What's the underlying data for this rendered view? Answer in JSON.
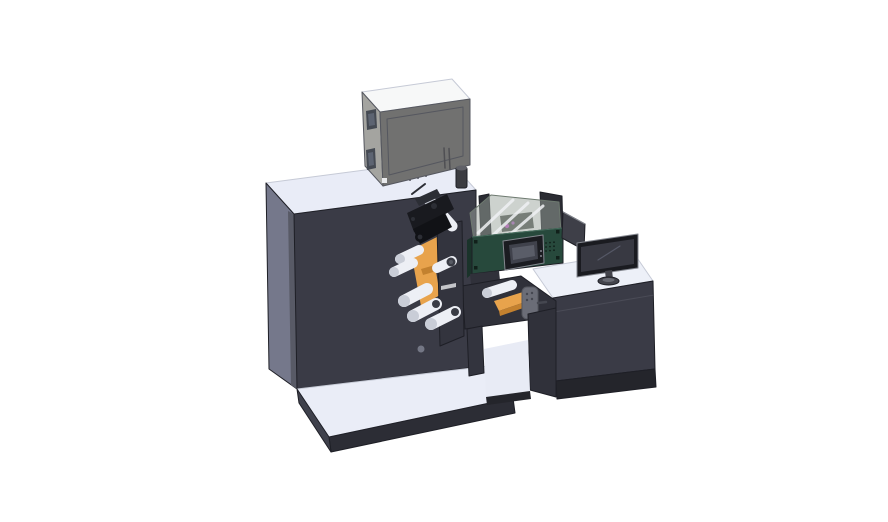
{
  "canvas": {
    "width": 888,
    "height": 522,
    "background": "#ffffff"
  },
  "scene": {
    "kind": "3d-cad-render",
    "parts": [
      "printing-machine-cabinet",
      "electrical-box",
      "exhaust-cylinder",
      "print-head-assembly",
      "guide-rollers",
      "label-web-rolls",
      "winder-door-plate",
      "inspection-unit",
      "protective-hood",
      "hmi-display",
      "operator-desk",
      "desk-side-panel",
      "monitor",
      "base-platform",
      "support-frame"
    ]
  },
  "colors": {
    "bg": "#ffffff",
    "topLight": "#e9ecf7",
    "baseTop": "#eaedf7",
    "cabinetFront": "#3a3b46",
    "cabinetLeft": "#75788b",
    "cabinetShade": "#585a66",
    "baseEdge": "#2c2d35",
    "baseSide": "#3f414c",
    "edgeDark": "#1e1f26",
    "edgeMid": "#55575f",
    "edgeLight": "#c6cad6",
    "seamGray": "#4a4b56",
    "boxTop": "#f7f8f8",
    "boxLeft": "#a4a4a0",
    "boxFront": "#717170",
    "boxWindow": "#454a53",
    "boxWindowInner": "#5d6472",
    "boxSlot": "#4f4f53",
    "latchWhite": "#e9eaec",
    "cylinderDark": "#3b3c41",
    "cylinderTop": "#606168",
    "deskTop": "#edf0f8",
    "deskFront": "#3a3b46",
    "plinth": "#24252b",
    "monitorBezel": "#1a1b20",
    "monitorScreen": "#383942",
    "monitorRim": "#7e818c",
    "reflection": "#555866",
    "standGray": "#43444c",
    "standInner": "#686a73",
    "sidePanelGray": "#3e3f48",
    "tealPanel": "#27493c",
    "tealEdgeDark": "#1a332a",
    "tealLight": "#47705f",
    "boltDark": "#11201a",
    "hoodGlass": "#9ca69e",
    "hoodFrame": "#6e7a70",
    "strutWhite": "#eef1f3",
    "innardsDark": "#3f443f",
    "magenta": "#cb59cf",
    "magenta2": "#b469c9",
    "hmiHousing": "#1b1c21",
    "hmiScreen": "#40424c",
    "hmiScreenInner": "#5a5d68",
    "silver": "#84878f",
    "orange": "#e8a34c",
    "orangeDark": "#c3812f",
    "headBlack": "#191a1f",
    "headBlack2": "#111216",
    "headDetail": "#2c2e35",
    "rollerWhite": "#edeff5",
    "rollerShade": "#c9cdd7",
    "rollerCore": "#3a3c45",
    "rollerCoreInner": "#585b64",
    "bracketGray": "#6b6d77",
    "bracketHole": "#454750",
    "structDark": "#30313a",
    "structDark2": "#33343e",
    "darkWall": "#2b2c33",
    "interiorWhite": "#e8ebf5",
    "knobGray": "#8d92a0"
  }
}
